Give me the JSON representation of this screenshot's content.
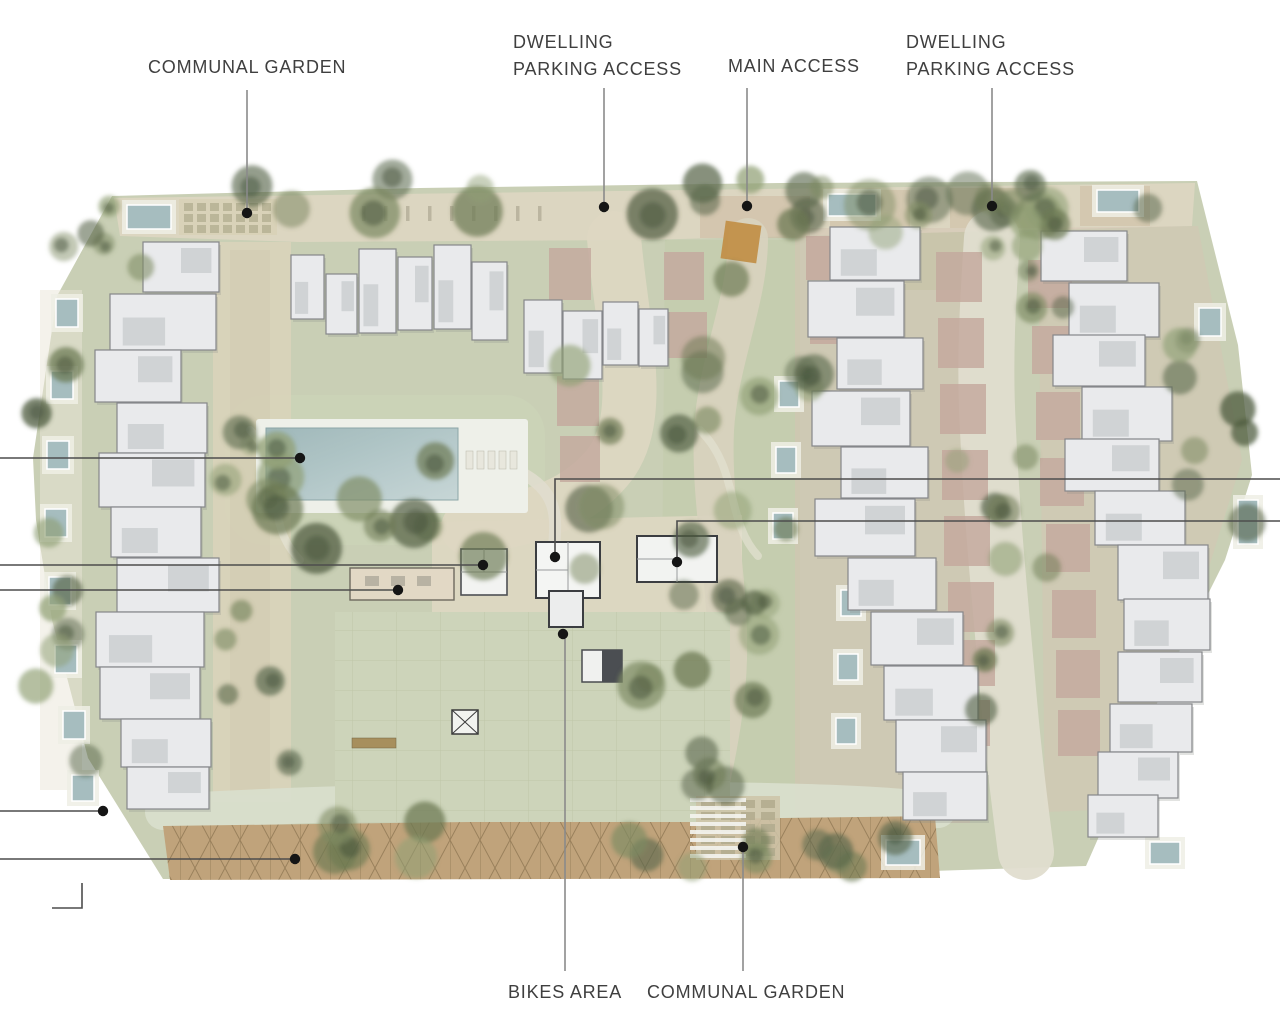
{
  "page": {
    "background": "#ffffff",
    "type": "residential masterplan site plan"
  },
  "plan_colors": {
    "site_green": "#c9cfb3",
    "lawn_light": "#ccd4b6",
    "paving_cream": "#ded7c0",
    "road_pale": "#e0ddcd",
    "parking_tan": "#cdb99e",
    "pergola_tan": "#c2a377",
    "driveway_mauve": "#c6a89b",
    "building_fill": "#e9eaec",
    "building_stroke": "#85878a",
    "amenity_stroke": "#3b3d41",
    "pool_teal": "#a4bdc0",
    "tree_olive": "#6b7950",
    "accent_orange": "#c68e3f",
    "label_text": "#3f3f3f",
    "label_leader_line": "#8a8a8a",
    "edge_leader_line": "#4d4d4d",
    "leader_dot": "#151515"
  },
  "labels": [
    {
      "id": "communal-garden-top",
      "lines": [
        "COMMUNAL GARDEN"
      ],
      "text_pos": [
        148,
        54
      ],
      "leader": [
        [
          247,
          90
        ],
        [
          247,
          213
        ]
      ],
      "dot": [
        247,
        213
      ]
    },
    {
      "id": "dwelling-parking-access-west",
      "lines": [
        "DWELLING",
        "PARKING ACCESS"
      ],
      "text_pos": [
        513,
        29
      ],
      "leader": [
        [
          604,
          88
        ],
        [
          604,
          207
        ]
      ],
      "dot": [
        604,
        207
      ]
    },
    {
      "id": "main-access",
      "lines": [
        "MAIN ACCESS"
      ],
      "text_pos": [
        728,
        53
      ],
      "leader": [
        [
          747,
          88
        ],
        [
          747,
          206
        ]
      ],
      "dot": [
        747,
        206
      ]
    },
    {
      "id": "dwelling-parking-access-east",
      "lines": [
        "DWELLING",
        "PARKING ACCESS"
      ],
      "text_pos": [
        906,
        29
      ],
      "leader": [
        [
          992,
          88
        ],
        [
          992,
          206
        ]
      ],
      "dot": [
        992,
        206
      ]
    },
    {
      "id": "bikes-area",
      "lines": [
        "BIKES AREA"
      ],
      "text_pos": [
        508,
        979
      ],
      "leader": [
        [
          565,
          971
        ],
        [
          565,
          634
        ]
      ],
      "dot": [
        563,
        634
      ]
    },
    {
      "id": "communal-garden-bottom",
      "lines": [
        "COMMUNAL GARDEN"
      ],
      "text_pos": [
        647,
        979
      ],
      "leader": [
        [
          743,
          971
        ],
        [
          743,
          847
        ]
      ],
      "dot": [
        743,
        847
      ]
    }
  ],
  "edge_leaders": [
    {
      "id": "left-to-pool",
      "points": [
        [
          0,
          458
        ],
        [
          300,
          458
        ]
      ],
      "dot": [
        300,
        458
      ]
    },
    {
      "id": "left-to-building-a",
      "points": [
        [
          0,
          565
        ],
        [
          483,
          565
        ]
      ],
      "dot": [
        483,
        565
      ]
    },
    {
      "id": "left-to-building-b",
      "points": [
        [
          0,
          590
        ],
        [
          398,
          590
        ]
      ],
      "dot": [
        398,
        590
      ]
    },
    {
      "id": "left-to-road",
      "points": [
        [
          0,
          811
        ],
        [
          103,
          811
        ]
      ],
      "dot": [
        103,
        811
      ]
    },
    {
      "id": "left-to-pergola",
      "points": [
        [
          0,
          859
        ],
        [
          295,
          859
        ]
      ],
      "dot": [
        295,
        859
      ]
    },
    {
      "id": "left-corner-stub",
      "points": [
        [
          52,
          908
        ],
        [
          82,
          908
        ],
        [
          82,
          883
        ]
      ],
      "dot": null
    },
    {
      "id": "right-to-building-a",
      "points": [
        [
          1280,
          479
        ],
        [
          555,
          479
        ],
        [
          555,
          557
        ]
      ],
      "dot": [
        555,
        557
      ]
    },
    {
      "id": "right-to-building-b",
      "points": [
        [
          1280,
          521
        ],
        [
          677,
          521
        ],
        [
          677,
          562
        ]
      ],
      "dot": [
        677,
        562
      ]
    }
  ]
}
